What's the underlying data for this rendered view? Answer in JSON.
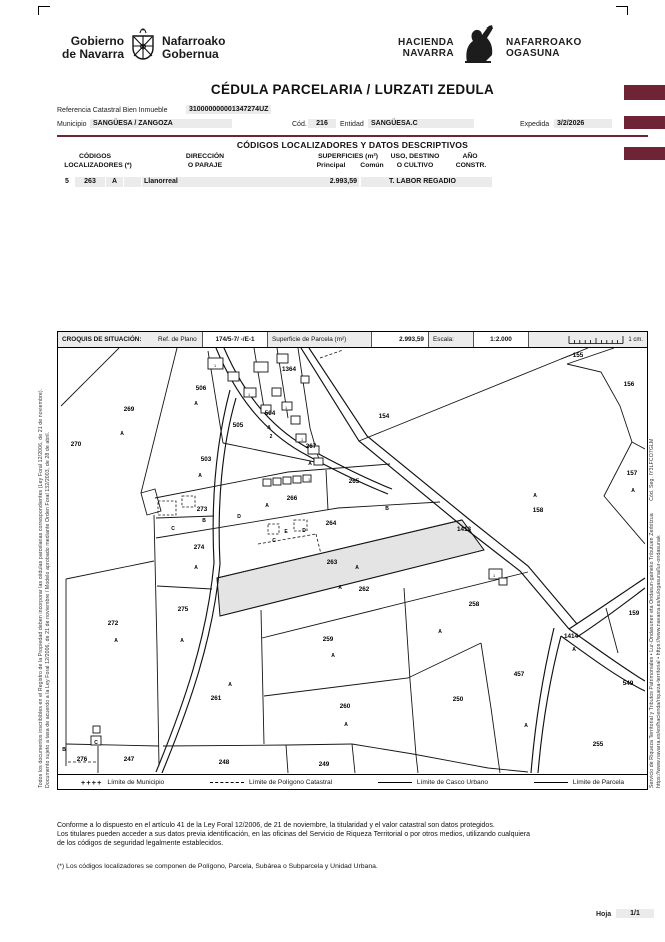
{
  "header": {
    "gov_logo": {
      "line1": "Gobierno",
      "line2": "de Navarra",
      "line3": "Nafarroako",
      "line4": "Gobernua"
    },
    "hacienda_logo": {
      "line1": "HACIENDA",
      "line2": "NAVARRA",
      "line3": "NAFARROAKO",
      "line4": "OGASUNA"
    },
    "title": "CÉDULA PARCELARIA / LURZATI ZEDULA"
  },
  "reference": {
    "ref_label": "Referencia Catastral Bien Inmueble",
    "ref_value": "310000000001347274UZ",
    "municipio_label": "Municipio",
    "municipio_value": "SANGÜESA / ZANGOZA",
    "cod_label": "Cód.",
    "cod_value": "216",
    "entidad_label": "Entidad",
    "entidad_value": "SANGÜESA.C",
    "expedida_label": "Expedida",
    "expedida_value": "3/2/2026"
  },
  "descriptive_table": {
    "section_title": "CÓDIGOS LOCALIZADORES Y DATOS DESCRIPTIVOS",
    "col_codigos_1": "CÓDIGOS",
    "col_codigos_2": "LOCALIZADORES (*)",
    "col_direccion_1": "DIRECCIÓN",
    "col_direccion_2": "O PARAJE",
    "col_superficies": "SUPERFICIES (m²)",
    "col_principal": "Principal",
    "col_comun": "Común",
    "col_uso_1": "USO, DESTINO",
    "col_uso_2": "O CULTIVO",
    "col_anio_1": "AÑO",
    "col_anio_2": "CONSTR.",
    "row": {
      "poligono": "5",
      "parcela": "263",
      "subarea": "A",
      "unidad": "",
      "direccion": "Llanorreal",
      "sup_principal": "2.993,59",
      "sup_comun": "",
      "uso": "T. LABOR REGADIO",
      "anio": ""
    }
  },
  "croquis": {
    "title": "CROQUIS DE SITUACIÓN:",
    "ref_plano_label": "Ref. de Plano",
    "ref_plano_value": "174/5-7/ -/E-1",
    "superficie_label": "Superficie de Parcela (m²)",
    "superficie_value": "2.993,59",
    "escala_label": "Escala:",
    "escala_value": "1:2.000",
    "scale_caption": "1 cm.",
    "highlight_color": "#e4e4e4",
    "legend": [
      {
        "type": "plus",
        "label": "Límite de Municipio"
      },
      {
        "type": "dash",
        "label": "Límite de Polígono Catastral"
      },
      {
        "type": "solid",
        "label": "Límite de Casco Urbano"
      },
      {
        "type": "solid",
        "label": "Límite de Parcela"
      }
    ],
    "labels": [
      [
        "270",
        18,
        96,
        "n"
      ],
      [
        "269",
        71,
        61,
        "n"
      ],
      [
        "506",
        143,
        40,
        "n"
      ],
      [
        "1364",
        231,
        21,
        "n"
      ],
      [
        "504",
        212,
        65,
        "n"
      ],
      [
        "505",
        180,
        77,
        "n"
      ],
      [
        "503",
        148,
        111,
        "n"
      ],
      [
        "267",
        253,
        98,
        "n"
      ],
      [
        "265",
        296,
        133,
        "n"
      ],
      [
        "266",
        234,
        150,
        "n"
      ],
      [
        "273",
        144,
        161,
        "n"
      ],
      [
        "264",
        273,
        175,
        "n"
      ],
      [
        "263",
        274,
        214,
        "n"
      ],
      [
        "274",
        141,
        199,
        "n"
      ],
      [
        "272",
        55,
        275,
        "n"
      ],
      [
        "275",
        125,
        261,
        "n"
      ],
      [
        "262",
        306,
        241,
        "n"
      ],
      [
        "261",
        158,
        350,
        "n"
      ],
      [
        "259",
        270,
        291,
        "n"
      ],
      [
        "260",
        287,
        358,
        "n"
      ],
      [
        "258",
        416,
        256,
        "n"
      ],
      [
        "250",
        400,
        351,
        "n"
      ],
      [
        "457",
        461,
        326,
        "n"
      ],
      [
        "1414",
        513,
        288,
        "n"
      ],
      [
        "247",
        71,
        411,
        "n"
      ],
      [
        "248",
        166,
        414,
        "n"
      ],
      [
        "249",
        266,
        416,
        "n"
      ],
      [
        "276",
        24,
        411,
        "n"
      ],
      [
        "255",
        540,
        396,
        "n"
      ],
      [
        "549",
        570,
        335,
        "n"
      ],
      [
        "159",
        576,
        265,
        "n"
      ],
      [
        "154",
        326,
        68,
        "n"
      ],
      [
        "155",
        520,
        7,
        "n"
      ],
      [
        "156",
        571,
        36,
        "n"
      ],
      [
        "157",
        574,
        125,
        "n"
      ],
      [
        "158",
        480,
        162,
        "n"
      ],
      [
        "1413",
        406,
        181,
        "n"
      ],
      [
        "A",
        64,
        85,
        "s"
      ],
      [
        "A",
        138,
        55,
        "s"
      ],
      [
        "A",
        211,
        79,
        "s"
      ],
      [
        "2",
        213,
        88,
        "s"
      ],
      [
        "A",
        142,
        127,
        "s"
      ],
      [
        "A",
        252,
        115,
        "s"
      ],
      [
        "A",
        209,
        157,
        "s"
      ],
      [
        "A",
        477,
        147,
        "s"
      ],
      [
        "A",
        575,
        142,
        "s"
      ],
      [
        "A",
        58,
        292,
        "s"
      ],
      [
        "A",
        124,
        292,
        "s"
      ],
      [
        "A",
        138,
        219,
        "s"
      ],
      [
        "A",
        172,
        336,
        "s"
      ],
      [
        "A",
        282,
        239,
        "s"
      ],
      [
        "A",
        299,
        219,
        "s"
      ],
      [
        "A",
        275,
        307,
        "s"
      ],
      [
        "A",
        288,
        376,
        "s"
      ],
      [
        "A",
        382,
        283,
        "s"
      ],
      [
        "A",
        468,
        377,
        "s"
      ],
      [
        "A",
        516,
        301,
        "s"
      ],
      [
        "B",
        329,
        160,
        "s"
      ],
      [
        "B",
        146,
        172,
        "s"
      ],
      [
        "C",
        115,
        180,
        "s"
      ],
      [
        "D",
        181,
        168,
        "s"
      ],
      [
        "C",
        216,
        192,
        "s"
      ],
      [
        "D",
        246,
        182,
        "s"
      ],
      [
        "E",
        228,
        183,
        "s"
      ],
      [
        "B",
        6,
        401,
        "s"
      ],
      [
        "C",
        38,
        394,
        "s"
      ],
      [
        "1",
        157,
        17,
        "t"
      ],
      [
        "1",
        191,
        46,
        "t"
      ],
      [
        "1",
        228,
        59,
        "t"
      ],
      [
        "1",
        244,
        91,
        "t"
      ],
      [
        "1",
        436,
        227,
        "t"
      ],
      [
        "1",
        251,
        131,
        "t"
      ]
    ]
  },
  "side_notes": {
    "left_outer": "Todos los documentos inscribibles en el Registro de la Propiedad deben incorporar las cédulas parcelarias correspondientes (Ley Foral 12/2006, de 21 de noviembre).",
    "left_inner": "Documento sujeto a tasa de acuerdo a la Ley Foral 12/2006, de 21 de noviembre / Modelo aprobado mediante Orden Foral 132/2003, de 28 de abril.",
    "right_inner": "Servicio de Riqueza Territorial y Tributos Patrimoniales • Lur-Ondasunen eta Ondasun-gaineko Tributuen Zerbitzua        Cód. Seg. IY3LFCO7GLM",
    "right_outer": "https://www.navarra.es/es/hacienda/riqueza-territorial • https://www.navarra.es/eu/ogasuna/lur-ondasunak"
  },
  "footer": {
    "line1": "Conforme a lo dispuesto en el artículo 41 de la Ley Foral 12/2006, de 21 de noviembre, la titularidad y el valor catastral son datos protegidos.",
    "line2": "Los titulares pueden acceder a sus datos previa identificación, en las oficinas del Servicio de Riqueza Territorial o por otros medios, utilizando cualquiera",
    "line3": "de los códigos de seguridad legalmente establecidos.",
    "note": "(*) Los códigos localizadores se componen de Polígono, Parcela, Subárea o Subparcela y Unidad Urbana.",
    "hoja_label": "Hoja",
    "hoja_value": "1/1"
  },
  "colors": {
    "accent_maroon": "#6e2434"
  }
}
